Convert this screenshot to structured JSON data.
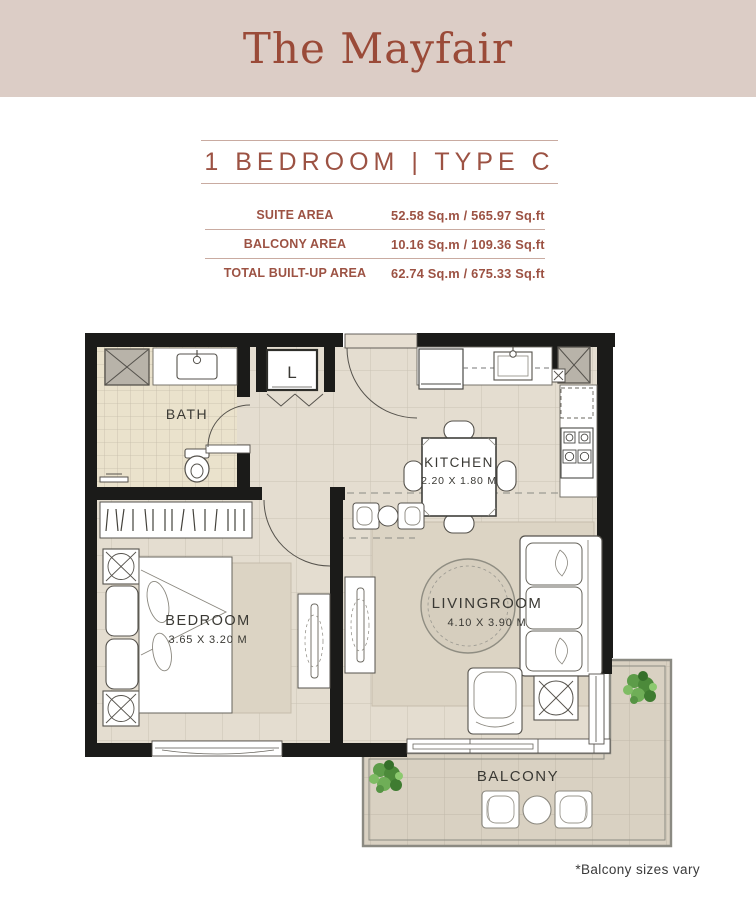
{
  "header": {
    "title": "The Mayfair"
  },
  "unit": {
    "title": "1 BEDROOM | TYPE C",
    "areas": [
      {
        "label": "SUITE AREA",
        "value": "52.58 Sq.m / 565.97 Sq.ft"
      },
      {
        "label": "BALCONY AREA",
        "value": "10.16 Sq.m / 109.36 Sq.ft"
      },
      {
        "label": "TOTAL BUILT-UP AREA",
        "value": "62.74 Sq.m / 675.33 Sq.ft"
      }
    ]
  },
  "plan": {
    "labels": {
      "bath": "BATH",
      "kitchen": "KITCHEN",
      "kitchen_dims": "2.20 X 1.80 M",
      "bedroom": "BEDROOM",
      "bedroom_dims": "3.65 X 3.20 M",
      "livingroom": "LIVINGROOM",
      "livingroom_dims": "4.10 X 3.90 M",
      "balcony": "BALCONY",
      "laundry_closet": "L"
    }
  },
  "footnote": {
    "text": "*Balcony sizes vary"
  },
  "colors": {
    "header_background": "#dccdc6",
    "accent_terracotta": "#9c5243",
    "wall": "#1b1b19",
    "floor": "#e4ddd0",
    "bath_floor": "#eae2cc",
    "balcony_floor": "#d9d1c2",
    "rug": "#dcd4c4",
    "plant_green": "#5d9c49",
    "plan_text": "#3a3934"
  }
}
